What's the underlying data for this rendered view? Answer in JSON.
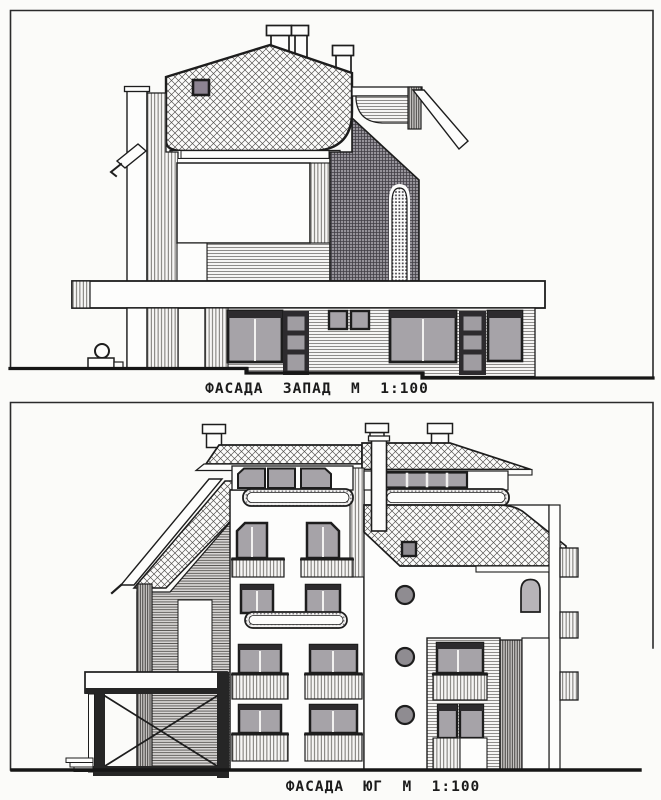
{
  "sheet": {
    "type": "architectural elevation drawings (scanned)",
    "background_color": "#fbfbf9",
    "ink_color": "#1f1f1f",
    "glass_gray": "#a6a3a8",
    "roof_vent_gray": "#8d8492",
    "dark_fill": "#2d2b2e"
  },
  "captions": {
    "west": "ФАСАДА  ЗАПАД  М  1:100",
    "south": "ФАСАДА  ЮГ  М  1:100"
  },
  "drawings": [
    {
      "id": "west-elevation",
      "title": "ФАСАДА ЗАПАД",
      "scale": "М 1:100"
    },
    {
      "id": "south-elevation",
      "title": "ФАСАДА ЮГ",
      "scale": "М 1:100"
    }
  ]
}
